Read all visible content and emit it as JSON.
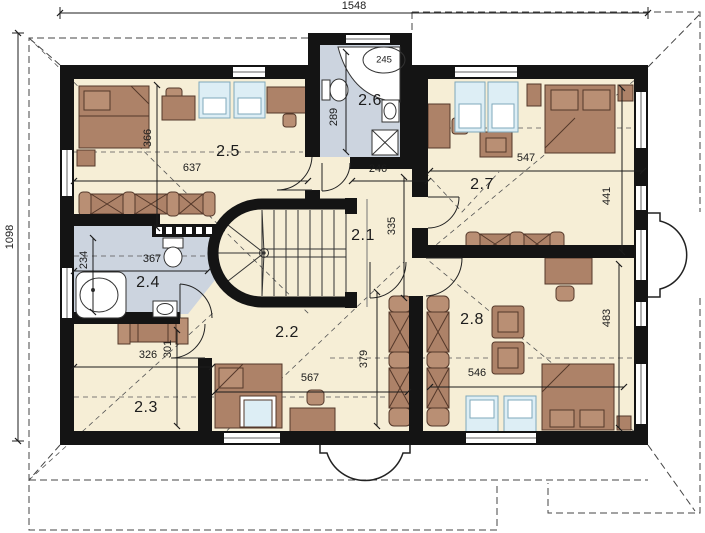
{
  "plan": {
    "overall": {
      "width_cm": "1548",
      "height_cm": "1098"
    },
    "rooms": {
      "r21": {
        "number": "2.1",
        "width_cm": "246",
        "depth_cm": "335"
      },
      "r22": {
        "number": "2.2",
        "width_cm": "567",
        "depth_cm": "379"
      },
      "r23": {
        "number": "2.3",
        "width_cm": "326",
        "depth_cm": "301"
      },
      "r24": {
        "number": "2.4",
        "width_cm": "367",
        "depth_cm": "234"
      },
      "r25": {
        "number": "2.5",
        "width_cm": "637",
        "depth_cm": "366"
      },
      "r26": {
        "number": "2.6",
        "depth_cm": "289",
        "bathtub_cm": "245"
      },
      "r27": {
        "number": "2.7",
        "width_cm": "547",
        "depth_cm": "441"
      },
      "r28": {
        "number": "2.8",
        "width_cm": "546",
        "depth_cm": "483"
      }
    },
    "colors": {
      "wall": "#141414",
      "floor": "#f6eed6",
      "bath_floor": "#ccd4df",
      "furniture": "#ad8268",
      "furniture_outline": "#54382a",
      "glass": "#ddeef5",
      "line": "#1c1c1c"
    }
  }
}
